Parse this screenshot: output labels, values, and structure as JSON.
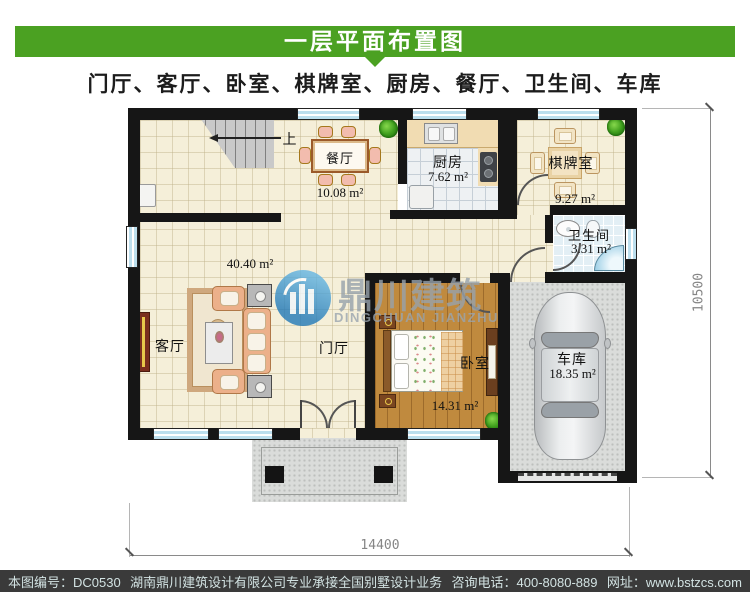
{
  "header": {
    "title": "一层平面布置图",
    "subtitle": "门厅、客厅、卧室、棋牌室、厨房、餐厅、卫生间、车库"
  },
  "plan": {
    "rooms": {
      "dining": {
        "label": "餐厅",
        "area": "10.08 m²"
      },
      "kitchen": {
        "label": "厨房",
        "area": "7.62 m²"
      },
      "chess": {
        "label": "棋牌室",
        "area": "9.27 m²"
      },
      "bath": {
        "label": "卫生间",
        "area": "3.31 m²"
      },
      "living": {
        "label": "客厅",
        "area": "40.40 m²"
      },
      "foyer": {
        "label": "门厅"
      },
      "bedroom": {
        "label": "卧室",
        "area": "14.31 m²"
      },
      "garage": {
        "label": "车库",
        "area": "18.35 m²"
      }
    },
    "stair": {
      "up_label": "上"
    },
    "dimensions": {
      "overall_width_mm": "14400",
      "overall_height_mm": "10500"
    }
  },
  "watermark": {
    "name_cn": "鼎川建筑",
    "name_en": "DINGCHUAN JIANZHU"
  },
  "footer": {
    "drawing_no": "本图编号：DC0530",
    "company": "湖南鼎川建筑设计有限公司专业承接全国别墅设计业务",
    "phone": "咨询电话：400-8080-889",
    "website": "网址：www.bstzcs.com"
  },
  "colors": {
    "banner_green": "#4ba122",
    "footer_bg": "#3a3a3a",
    "wall": "#161616",
    "window_blue": "#bcdfee"
  }
}
